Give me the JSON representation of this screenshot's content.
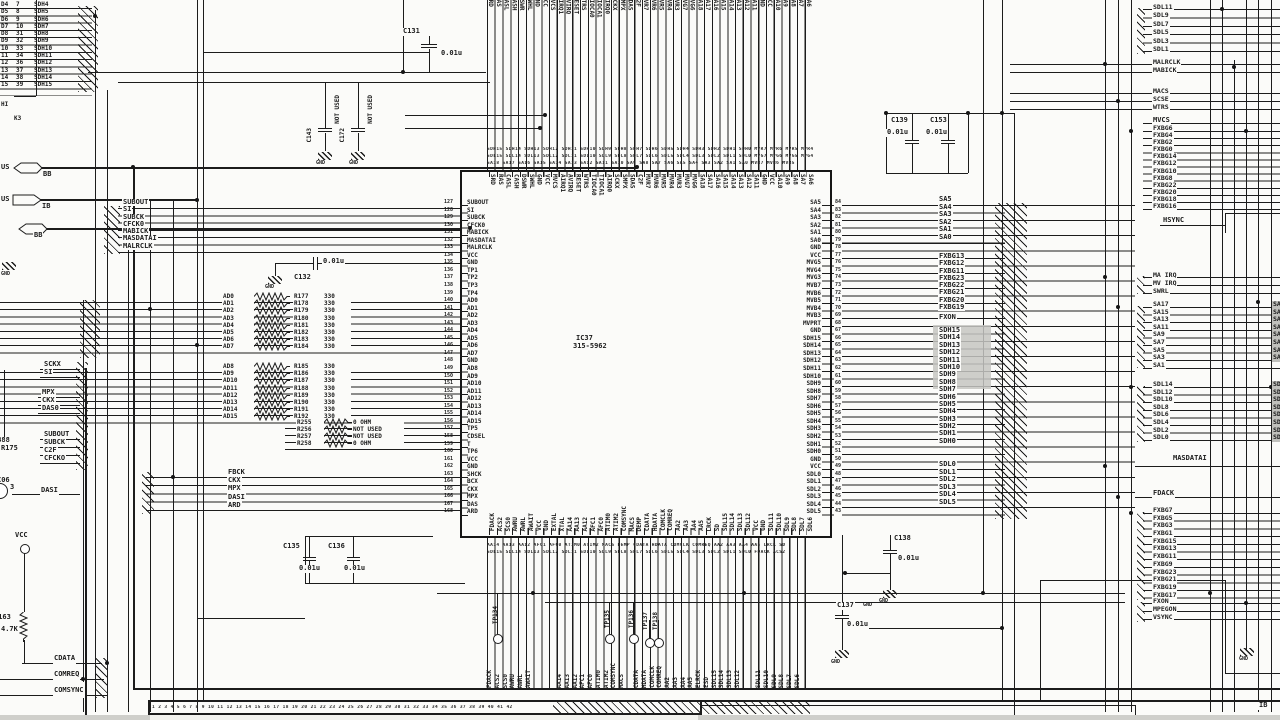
{
  "sheet": {
    "hi": "HI",
    "k3": "K3",
    "ib_bottom": "IB"
  },
  "gnd": "GND",
  "vcc": "VCC",
  "ic": {
    "ref": "IC37",
    "part": "315-5962",
    "left_pins": [
      {
        "n": "127",
        "l": "SUBOUT"
      },
      {
        "n": "128",
        "l": "SI"
      },
      {
        "n": "129",
        "l": "SUBCK"
      },
      {
        "n": "130",
        "l": "CFCK0"
      },
      {
        "n": "131",
        "l": "MABICK"
      },
      {
        "n": "132",
        "l": "MASDATAI"
      },
      {
        "n": "133",
        "l": "MALRCLK"
      },
      {
        "n": "134",
        "l": "VCC"
      },
      {
        "n": "135",
        "l": "GND"
      },
      {
        "n": "136",
        "l": "TP1"
      },
      {
        "n": "137",
        "l": "TP2"
      },
      {
        "n": "138",
        "l": "TP3"
      },
      {
        "n": "139",
        "l": "TP4"
      },
      {
        "n": "140",
        "l": "AD0"
      },
      {
        "n": "141",
        "l": "AD1"
      },
      {
        "n": "142",
        "l": "AD2"
      },
      {
        "n": "143",
        "l": "AD3"
      },
      {
        "n": "144",
        "l": "AD4"
      },
      {
        "n": "145",
        "l": "AD5"
      },
      {
        "n": "146",
        "l": "AD6"
      },
      {
        "n": "147",
        "l": "AD7"
      },
      {
        "n": "148",
        "l": "GND"
      },
      {
        "n": "149",
        "l": "AD8"
      },
      {
        "n": "150",
        "l": "AD9"
      },
      {
        "n": "151",
        "l": "AD10"
      },
      {
        "n": "152",
        "l": "AD11"
      },
      {
        "n": "153",
        "l": "AD12"
      },
      {
        "n": "154",
        "l": "AD13"
      },
      {
        "n": "155",
        "l": "AD14"
      },
      {
        "n": "156",
        "l": "AD15"
      },
      {
        "n": "157",
        "l": "TP5"
      },
      {
        "n": "158",
        "l": "CDSEL"
      },
      {
        "n": "159",
        "l": "T"
      },
      {
        "n": "160",
        "l": "TP6"
      },
      {
        "n": "161",
        "l": "VCC"
      },
      {
        "n": "162",
        "l": "GND"
      },
      {
        "n": "163",
        "l": "SHCK"
      },
      {
        "n": "164",
        "l": "BCX"
      },
      {
        "n": "165",
        "l": "CKX"
      },
      {
        "n": "166",
        "l": "MPX"
      },
      {
        "n": "167",
        "l": "DAS"
      },
      {
        "n": "168",
        "l": "ARD"
      }
    ],
    "right_pins": [
      {
        "n": "84",
        "l": "SA5"
      },
      {
        "n": "83",
        "l": "SA4"
      },
      {
        "n": "82",
        "l": "SA3"
      },
      {
        "n": "81",
        "l": "SA2"
      },
      {
        "n": "80",
        "l": "SA1"
      },
      {
        "n": "79",
        "l": "SA0"
      },
      {
        "n": "78",
        "l": "GND"
      },
      {
        "n": "77",
        "l": "VCC"
      },
      {
        "n": "76",
        "l": "MVG5"
      },
      {
        "n": "75",
        "l": "MVG4"
      },
      {
        "n": "74",
        "l": "MVG3"
      },
      {
        "n": "73",
        "l": "MVB7"
      },
      {
        "n": "72",
        "l": "MVB6"
      },
      {
        "n": "71",
        "l": "MVB5"
      },
      {
        "n": "70",
        "l": "MVB4"
      },
      {
        "n": "69",
        "l": "MVB3"
      },
      {
        "n": "68",
        "l": "MVPRT"
      },
      {
        "n": "67",
        "l": "GND"
      },
      {
        "n": "66",
        "l": "SDH15"
      },
      {
        "n": "65",
        "l": "SDH14"
      },
      {
        "n": "64",
        "l": "SDH13"
      },
      {
        "n": "63",
        "l": "SDH12"
      },
      {
        "n": "62",
        "l": "SDH11"
      },
      {
        "n": "61",
        "l": "SDH10"
      },
      {
        "n": "60",
        "l": "SDH9"
      },
      {
        "n": "59",
        "l": "SDH8"
      },
      {
        "n": "58",
        "l": "SDH7"
      },
      {
        "n": "57",
        "l": "SDH6"
      },
      {
        "n": "56",
        "l": "SDH5"
      },
      {
        "n": "55",
        "l": "SDH4"
      },
      {
        "n": "54",
        "l": "SDH3"
      },
      {
        "n": "53",
        "l": "SDH2"
      },
      {
        "n": "52",
        "l": "SDH1"
      },
      {
        "n": "51",
        "l": "SDH0"
      },
      {
        "n": "50",
        "l": "GND"
      },
      {
        "n": "49",
        "l": "VCC"
      },
      {
        "n": "48",
        "l": "SDL0"
      },
      {
        "n": "47",
        "l": "SDL1"
      },
      {
        "n": "46",
        "l": "SDL2"
      },
      {
        "n": "45",
        "l": "SDL3"
      },
      {
        "n": "44",
        "l": "SDL4"
      },
      {
        "n": "43",
        "l": "SDL5"
      }
    ],
    "top_pins": [
      "SRD",
      "RAS",
      "CASL",
      "CASH",
      "DSWR",
      "SWHL",
      "GND",
      "VCC",
      "MVCS",
      "AIRQ1",
      "AVIRQ",
      "RESET",
      "WTRS",
      "TIOCA0",
      "TIOCA1",
      "AIRQ0",
      "SCKX",
      "SMPX",
      "SDAS",
      "C2F",
      "MVR7",
      "MVR6",
      "MVR5",
      "MVR4",
      "MVR3",
      "MVG7",
      "MVG6",
      "SA18",
      "SA17",
      "SA16",
      "SA15",
      "SA14",
      "SA13",
      "SA12",
      "SA11",
      "GND",
      "VCC",
      "SA10",
      "SA9",
      "SA8",
      "SA7",
      "SA6"
    ],
    "bottom_pins": [
      "FDACK",
      "ACS2",
      "SCS0",
      "AWRU",
      "AWRL",
      "AWAIT",
      "VCC",
      "GND",
      "EXTAL",
      "XTAL",
      "AA14",
      "AA13",
      "AA12",
      "AFC1",
      "AFC0",
      "ATIM0",
      "ATIM2",
      "COMSYNC",
      "MACS",
      "DEMP",
      "CDATA",
      "HDATA",
      "COMCLK",
      "COMREQ",
      "AA2",
      "AA3",
      "AA4",
      "AA5",
      "LRCK",
      "SD",
      "SDL15",
      "SDL14",
      "SDL13",
      "SDL12",
      "VCC",
      "GND",
      "SDL11",
      "SDL10",
      "SDL9",
      "SDL8",
      "SDL7",
      "SDL6"
    ]
  },
  "connector": {
    "rows": [
      {
        "d": "D4",
        "n": "7",
        "net": "SDH4"
      },
      {
        "d": "D5",
        "n": "8",
        "net": "SDH5"
      },
      {
        "d": "D6",
        "n": "9",
        "net": "SDH6"
      },
      {
        "d": "D7",
        "n": "10",
        "net": "SDH7"
      },
      {
        "d": "D8",
        "n": "31",
        "net": "SDH8"
      },
      {
        "d": "D9",
        "n": "32",
        "net": "SDH9"
      },
      {
        "d": "10",
        "n": "33",
        "net": "SDH10"
      },
      {
        "d": "11",
        "n": "34",
        "net": "SDH11"
      },
      {
        "d": "12",
        "n": "36",
        "net": "SDH12"
      },
      {
        "d": "13",
        "n": "37",
        "net": "SDH13"
      },
      {
        "d": "14",
        "n": "38",
        "net": "SDH14"
      },
      {
        "d": "15",
        "n": "39",
        "net": "SDH15"
      }
    ]
  },
  "bus_tags": {
    "us1": "US",
    "bb1": "BB",
    "us2": "US",
    "ib": "IB",
    "bb2": "BB"
  },
  "subnets": [
    "SUBOUT",
    "SI",
    "SUBCK",
    "CFCK0",
    "MABICK",
    "MASDATAI",
    "MALRCLK"
  ],
  "resistors": {
    "low": [
      {
        "net": "AD0",
        "ref": "R177",
        "val": "330"
      },
      {
        "net": "AD1",
        "ref": "R178",
        "val": "330"
      },
      {
        "net": "AD2",
        "ref": "R179",
        "val": "330"
      },
      {
        "net": "AD3",
        "ref": "R180",
        "val": "330"
      },
      {
        "net": "AD4",
        "ref": "R181",
        "val": "330"
      },
      {
        "net": "AD5",
        "ref": "R182",
        "val": "330"
      },
      {
        "net": "AD6",
        "ref": "R183",
        "val": "330"
      },
      {
        "net": "AD7",
        "ref": "R184",
        "val": "330"
      }
    ],
    "high": [
      {
        "net": "AD8",
        "ref": "R185",
        "val": "330"
      },
      {
        "net": "AD9",
        "ref": "R186",
        "val": "330"
      },
      {
        "net": "AD10",
        "ref": "R187",
        "val": "330"
      },
      {
        "net": "AD11",
        "ref": "R188",
        "val": "330"
      },
      {
        "net": "AD12",
        "ref": "R189",
        "val": "330"
      },
      {
        "net": "AD13",
        "ref": "R190",
        "val": "330"
      },
      {
        "net": "AD14",
        "ref": "R191",
        "val": "330"
      },
      {
        "net": "AD15",
        "ref": "R192",
        "val": "330"
      }
    ],
    "extra": [
      {
        "ref": "R255",
        "val": "0 OHM"
      },
      {
        "ref": "R256",
        "val": "NOT USED"
      },
      {
        "ref": "R257",
        "val": "NOT USED"
      },
      {
        "ref": "R258",
        "val": "0 OHM"
      }
    ],
    "signals": [
      "FBCK",
      "CKX",
      "MPX",
      "DASI",
      "ARD"
    ],
    "r163": {
      "ref": "R163",
      "val": "4.7K"
    }
  },
  "left_signals": {
    "g1": [
      "SCKX",
      "SI"
    ],
    "g2": [
      "MPX",
      "CKX",
      "DAS0"
    ],
    "g3": [
      "SUBOUT",
      "SUBCK",
      "C2F",
      "CFCKO"
    ],
    "dasi": "DASI",
    "r388": "R388",
    "r175": "R175",
    "c06": "C06",
    "pin3": "3",
    "bottom": [
      "CDATA",
      "COMREQ",
      "COMSYNC"
    ]
  },
  "caps": {
    "c131": {
      "ref": "C131",
      "val": "0.01u"
    },
    "c132": {
      "ref": "C132",
      "val": "0.01u"
    },
    "c143": {
      "ref": "C143",
      "note": "NOT USED"
    },
    "c172": {
      "ref": "C172",
      "note": "NOT USED"
    },
    "c139": {
      "ref": "C139",
      "val": "0.01u"
    },
    "c153": {
      "ref": "C153",
      "val": "0.01u"
    },
    "c135": {
      "ref": "C135",
      "val": "0.01u"
    },
    "c136": {
      "ref": "C136",
      "val": "0.01u"
    },
    "c137": {
      "ref": "C137",
      "val": "0.01u"
    },
    "c138": {
      "ref": "C138",
      "val": "0.01u"
    }
  },
  "right_mid": {
    "sa": [
      "SA5",
      "SA4",
      "SA3",
      "SA2",
      "SA1",
      "SA0"
    ],
    "fxbg": [
      "FXBG13",
      "FXBG12",
      "FXBG11",
      "FXBG23",
      "FXBG22",
      "FXBG21",
      "FXBG20",
      "FXBG19"
    ],
    "fxon": "FXON",
    "sdh": [
      "SDH15",
      "SDH14",
      "SDH13",
      "SDH12",
      "SDH11",
      "SDH10",
      "SDH9",
      "SDH8",
      "SDH7",
      "SDH6",
      "SDH5",
      "SDH4",
      "SDH3",
      "SDH2",
      "SDH1",
      "SDH0"
    ],
    "sdl": [
      "SDL0",
      "SDL1",
      "SDL2",
      "SDL3",
      "SDL4",
      "SDL5"
    ]
  },
  "right_edge": {
    "sdl_odd": [
      "SDL11",
      "SDL9",
      "SDL7",
      "SDL5",
      "SDL3",
      "SDL1"
    ],
    "clk": [
      "MALRCLK",
      "MABICK"
    ],
    "ctl": [
      "MACS",
      "SCSE",
      "WTRS"
    ],
    "mvcs": "MVCS",
    "fxbg_even": [
      "FXBG6",
      "FXBG4",
      "FXBG2",
      "FXBG0",
      "FXBG14",
      "FXBG12",
      "FXBG10",
      "FXBG8",
      "FXBG22",
      "FXBG20",
      "FXBG18",
      "FXBG16"
    ],
    "hsync": "HSYNC",
    "irq": [
      "MA IRQ",
      "MV IRQ",
      "SWRL"
    ],
    "sa_odd": [
      "SA17",
      "SA15",
      "SA13",
      "SA11",
      "SA9",
      "SA7",
      "SA5",
      "SA3",
      "SA1"
    ],
    "sdl_even": [
      "SDL14",
      "SDL12",
      "SDL10",
      "SDL8",
      "SDL6",
      "SDL4",
      "SDL2",
      "SDL0"
    ],
    "masdatai": "MASDATAI",
    "fdack": "FDACK",
    "fxbg_odd": [
      "FXBG7",
      "FXBG5",
      "FXBG3",
      "FXBG1",
      "FXBG15",
      "FXBG13",
      "FXBG11",
      "FXBG9",
      "FXBG23",
      "FXBG21",
      "FXBG19",
      "FXBG17"
    ],
    "misc": [
      "FXON",
      "MPEGON",
      "VSYNC"
    ],
    "clip_sa": [
      "SA16",
      "SA14",
      "SA12",
      "SA10",
      "SA8",
      "SA6",
      "SA4",
      "SA2"
    ],
    "clip_sdl": [
      "SDL15",
      "SDL13",
      "SDL11",
      "SDL9",
      "SDL7",
      "SDL5",
      "SDL3",
      "SDL1"
    ]
  },
  "testpoints": [
    "TP134",
    "TP135",
    "TP136",
    "TP137",
    "TP138"
  ],
  "bottom_row": {
    "g1": [
      "FDACK",
      "ACS2",
      "SCS0",
      "AWRU",
      "AWRL",
      "AWAIT"
    ],
    "g2": [
      "AA14",
      "AA13",
      "AA12",
      "AFC1",
      "AFC0",
      "ATIM0",
      "ATIM2",
      "COMSYNC",
      "MACS"
    ],
    "g3": [
      "CDATA",
      "HDATA",
      "COMCLK",
      "COMREQ",
      "AA2",
      "AA3",
      "AA4",
      "AA5",
      "ELRCK",
      "ESD",
      "SDL15",
      "SDL14",
      "SDL13",
      "SDL12"
    ],
    "g4": [
      "SDL11",
      "SDL10",
      "SDL9",
      "SDL8",
      "SDL7",
      "SDL6"
    ]
  },
  "tiny": {
    "r1": "SDH15 SDH14 SDH13 SDH12 SDH11 SDH10 SDH9 SDH8 SDH7 SDH6 SDH5 SDH4 SDH3 SDH2 SDH1 SDH0 MVR7 MVR6 MVR5 MVR4",
    "r2": "SDL15 SDL14 SDL13 SDL12 SDL11 SDL10 SDL9 SDL8 SDL7 SDL6 SDL5 SDL4 SDL3 SDL2 SDL1 SDL0 MVG7 MVG6 MVG5 MVG4",
    "r3": "SA18 SA17 SA16 SA15 SA14 SA13 SA12 SA11 SA10 SA9 SA8 SA7 SA6 SA5 SA4 SA3 SA2 SA1 SA0 MVB7 MVB6 MVB5",
    "b1": "AA14 AA13 AA12 AFC1 AFC0 ATIM0 ATIM2 MACS DEMP CDATA HDATA COMCLK COMREQ AA2 AA3 AA4 AA5 LRCK SD",
    "b2": "SDL15 SDL14 SDL13 SDL12 SDL11 SDL10 SDL9 SDL8 SDL7 SDL6 SDL5 SDL4 SDL3 SDL2 SDL1 SDL0 FDACK ACS2",
    "digits": "1 2 3 4 5 6 7 8 9 10 11 12 13 14 15 16 17 18 19 20 21 22 23 24 25 26 27 28 29 30 31 32 33 34 35 36 37 38 39 40 41 42"
  }
}
